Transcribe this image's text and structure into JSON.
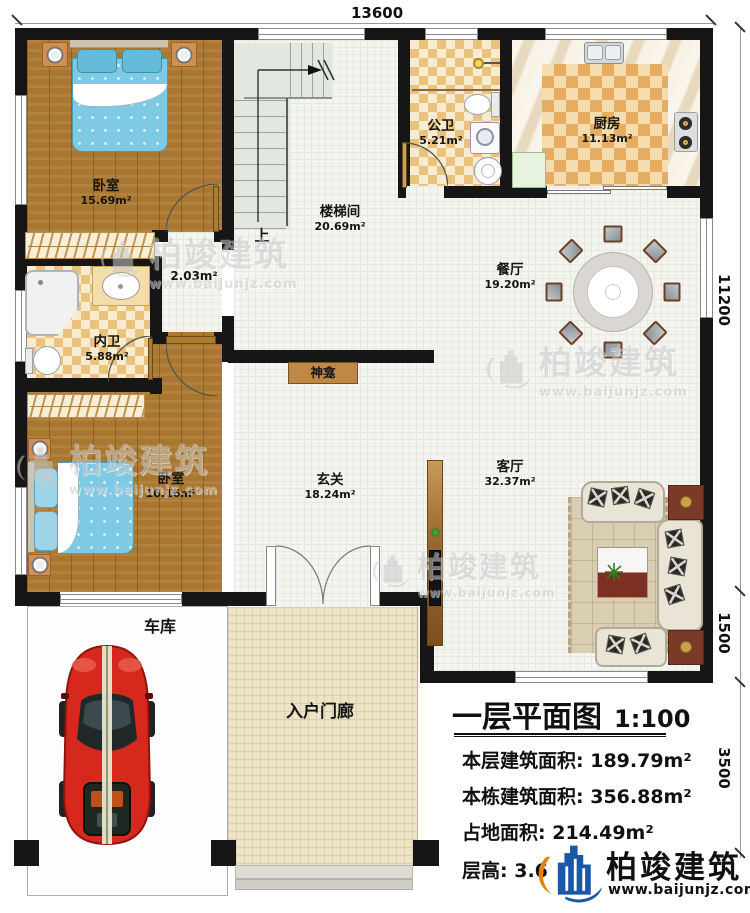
{
  "plan": {
    "dim_top": "13600",
    "dim_right_upper": "11200",
    "dim_right_mid": "1500",
    "dim_right_lower": "3500"
  },
  "rooms": {
    "bedroom1": {
      "name": "卧室",
      "area": "15.69m²"
    },
    "stairwell": {
      "name": "楼梯间",
      "area": "20.69m²",
      "up": "上"
    },
    "corridor": {
      "area": "2.03m²"
    },
    "public_bath": {
      "name": "公卫",
      "area": "5.21m²"
    },
    "kitchen": {
      "name": "厨房",
      "area": "11.13m²"
    },
    "dining": {
      "name": "餐厅",
      "area": "19.20m²"
    },
    "inner_bath": {
      "name": "内卫",
      "area": "5.88m²"
    },
    "bedroom2": {
      "name": "卧室",
      "area": "16.16m²"
    },
    "shrine": {
      "name": "神龛"
    },
    "foyer": {
      "name": "玄关",
      "area": "18.24m²"
    },
    "living": {
      "name": "客厅",
      "area": "32.37m²"
    },
    "garage": {
      "name": "车库"
    },
    "porch": {
      "name": "入户门廊"
    }
  },
  "title_block": {
    "title": "一层平面图",
    "scale": "1:100",
    "rows": [
      {
        "label": "本层建筑面积:",
        "value": "189.79m²"
      },
      {
        "label": "本栋建筑面积:",
        "value": "356.88m²"
      },
      {
        "label": "占地面积:",
        "value": "214.49m²"
      },
      {
        "label": "层高:",
        "value": "3.6"
      }
    ]
  },
  "brand": {
    "name": "柏竣建筑",
    "url": "www.baijunjz.com"
  },
  "watermark": {
    "name": "柏竣建筑",
    "url": "www.baijunjz.com"
  },
  "colors": {
    "wall": "#161616",
    "logo_blue": "#1a57a8",
    "logo_orange": "#e8820c",
    "car_red": "#d6281c",
    "water_blue": "#7ecae4"
  }
}
